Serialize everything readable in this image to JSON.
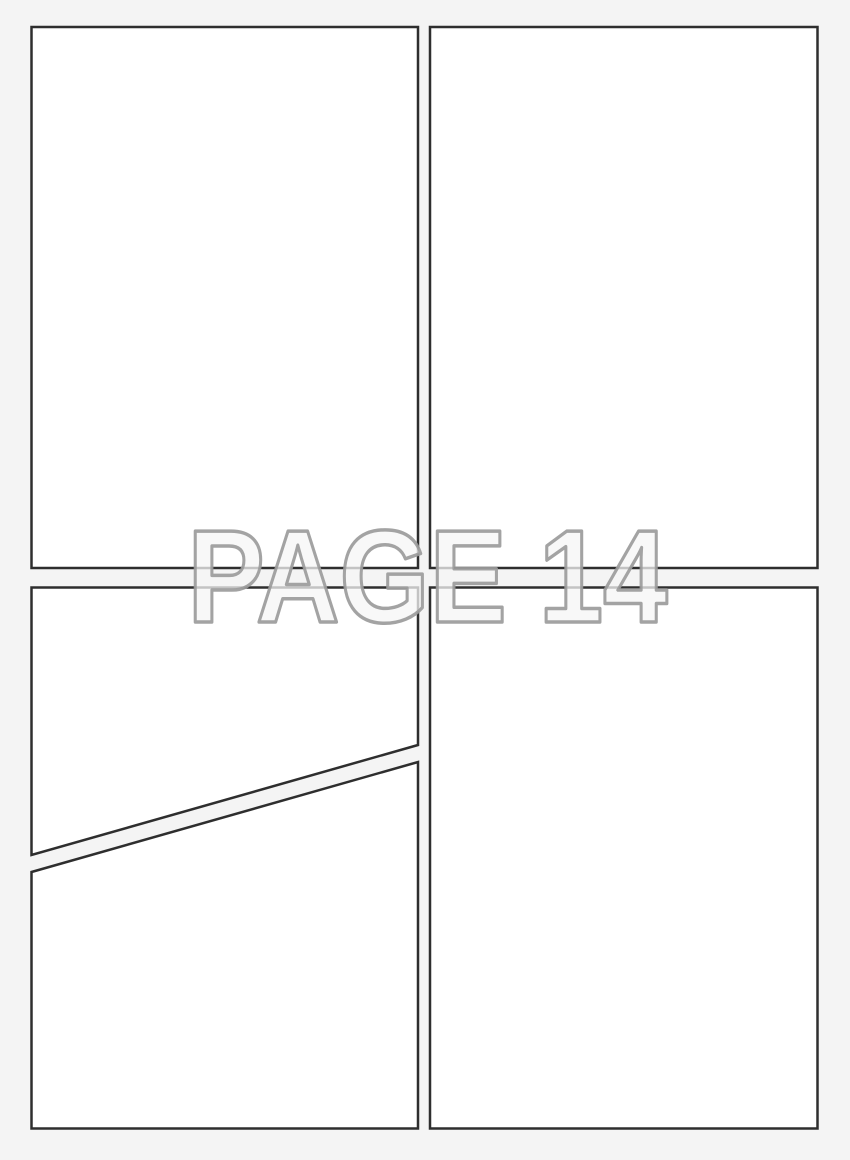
{
  "page": {
    "kind": "comic-page-template",
    "watermark": {
      "text": "PAGE 14"
    },
    "panels": [
      {
        "id": "panel-top-left",
        "shape": "rectangle"
      },
      {
        "id": "panel-top-right",
        "shape": "rectangle"
      },
      {
        "id": "panel-bottom-left-upper",
        "shape": "diagonal-cut"
      },
      {
        "id": "panel-bottom-left-lower",
        "shape": "diagonal-cut"
      },
      {
        "id": "panel-bottom-right",
        "shape": "rectangle"
      }
    ]
  },
  "colors": {
    "background": "#f4f4f4",
    "panel_fill": "#ffffff",
    "panel_border": "#2e2e2e",
    "watermark_stroke": "#9b9b9b",
    "watermark_fill": "#f5f5f5"
  }
}
